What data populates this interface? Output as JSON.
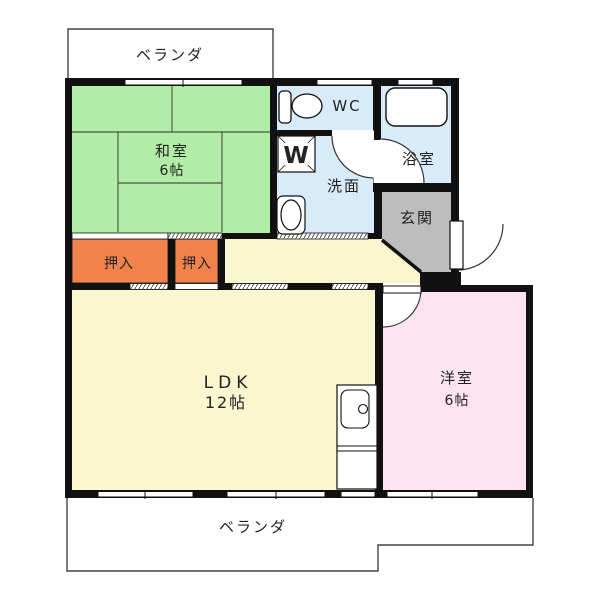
{
  "floorplan": {
    "type": "apartment-floor-plan",
    "labels": {
      "balcony_top": "ベランダ",
      "balcony_bottom": "ベランダ",
      "washitsu": "和室",
      "washitsu_size": "6帖",
      "wc": "WC",
      "bath": "浴室",
      "washroom": "洗面",
      "washer_mark": "W",
      "entrance": "玄関",
      "closet1": "押入",
      "closet2": "押入",
      "ldk": "LDK",
      "ldk_size": "12帖",
      "yoshitsu": "洋室",
      "yoshitsu_size": "6帖"
    },
    "rooms": [
      {
        "name": "和室",
        "size": "6帖"
      },
      {
        "name": "LDK",
        "size": "12帖"
      },
      {
        "name": "洋室",
        "size": "6帖"
      },
      {
        "name": "WC",
        "size": ""
      },
      {
        "name": "浴室",
        "size": ""
      },
      {
        "name": "洗面",
        "size": ""
      },
      {
        "name": "玄関",
        "size": ""
      },
      {
        "name": "押入",
        "size": ""
      },
      {
        "name": "押入",
        "size": ""
      },
      {
        "name": "ベランダ",
        "size": ""
      },
      {
        "name": "ベランダ",
        "size": ""
      }
    ],
    "colors": {
      "wall": "#111111",
      "tatami_green": "#b2eda7",
      "closet_orange": "#f2824b",
      "ldk_yellow": "#faf6d0",
      "bedroom_pink": "#fce3ef",
      "wet_blue": "#d7ecf8",
      "entrance_gray": "#bdbdbd",
      "outline": "#444444",
      "text": "#222222",
      "closet_text": "#7a1f12"
    }
  }
}
